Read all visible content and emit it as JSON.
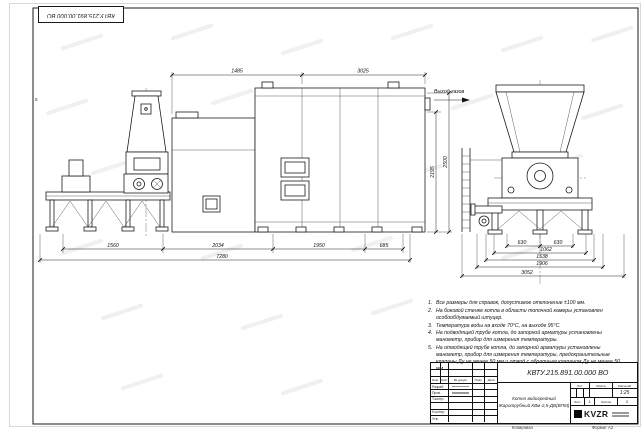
{
  "stamp": {
    "designation": "КВТУ.215.891.00.000 ВО"
  },
  "labels": {
    "gas_outlet": "Выход газов",
    "zone": "8"
  },
  "dims": {
    "top": [
      "1485",
      "3025"
    ],
    "side_bottom": [
      "1560",
      "2034",
      "1950",
      "685"
    ],
    "side_overall": "7280",
    "side_vertical": [
      "2195",
      "2500"
    ],
    "end_row1": [
      "630",
      "630"
    ],
    "end_stack": [
      "1062",
      "1538",
      "1906"
    ],
    "end_overall": "3052"
  },
  "notes": {
    "items": [
      {
        "n": "1.",
        "t": "Все размеры для справок, допустимое отклонение ±100 мм."
      },
      {
        "n": "2.",
        "t": "На боковой стенке котла в области топочной камеры установлен особообдуваемый штуцер."
      },
      {
        "n": "3.",
        "t": "Температура воды на входе 70°С, на выходе 95°С."
      },
      {
        "n": "4.",
        "t": "На подводящей трубе котла, до запорной арматуры установлены манометр, прибор для измерения температуры."
      },
      {
        "n": "5.",
        "t": "На отводящей трубе котла, до запорной арматуры установлены манометр, прибор для измерения температуры, предохранительные клапаны Ду не менее 50 мм и отвод с обратным клапаном Ду не менее 50 мм."
      }
    ]
  },
  "title_block": {
    "designation": "КВТУ.215.891.00.000 ВО",
    "name_line1": "Котел водогрейный",
    "name_line2": "Жаротрубный КВм-2,5-ДВ(ВПМ)",
    "cols": {
      "izm": "Изм.",
      "list": "Лист",
      "doc": "№ докум.",
      "sign": "Подп.",
      "date": "Дата"
    },
    "rows": [
      "Разраб.",
      "Пров.",
      "Т.контр.",
      "Н.контр.",
      "Утв."
    ],
    "lit_label": "Лит.",
    "mass_label": "Масса",
    "scale_label": "Масштаб",
    "scale_value": "1:25",
    "sheet_label": "Лист",
    "sheet_value": "1",
    "sheets_label": "Листов",
    "sheets_value": "2",
    "logo": "KVZR"
  },
  "footer": {
    "copied": "Копировал",
    "format": "Формат А2"
  }
}
